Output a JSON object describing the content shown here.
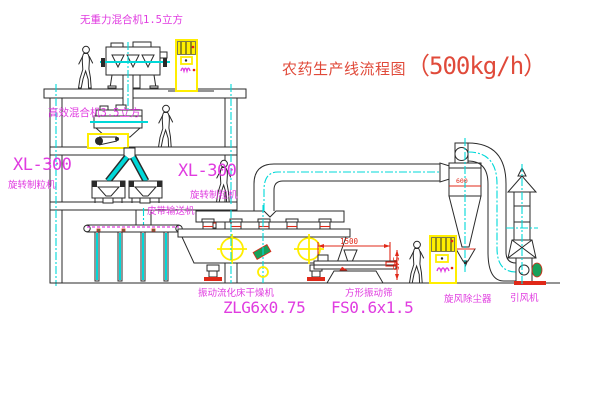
{
  "diagram": {
    "title_cn": "农药生产线流程图",
    "title_capacity": "（500kg/h）"
  },
  "labels": {
    "top_mixer": "无重力混合机1.5立方",
    "second_mixer": "高效混合机3.5立方",
    "granulator_left_model": "XL-300",
    "granulator_left_name": "旋转制粒机",
    "granulator_right_model": "XL-300",
    "granulator_right_name": "旋转制粒机",
    "belt_conveyor": "皮带输送机",
    "dryer_name": "振动流化床干燥机",
    "dryer_model": "ZLG6x0.75",
    "sieve_name": "方形振动筛",
    "sieve_model": "FS0.6x1.5",
    "cyclone_name": "旋风除尘器",
    "fan_name": "引风机"
  },
  "dimensions": {
    "sieve_length": "1500",
    "sieve_height": "545",
    "cyclone_dim": "600"
  },
  "colors": {
    "line": "#2a2a2a",
    "centerline": "#00d8d8",
    "label_magenta": "#e03ce0",
    "title_red": "#e04a3a",
    "dimension_red": "#e02818",
    "cabinet_yellow": "#ffee00",
    "machine_green": "#17a05a",
    "background": "#ffffff"
  }
}
